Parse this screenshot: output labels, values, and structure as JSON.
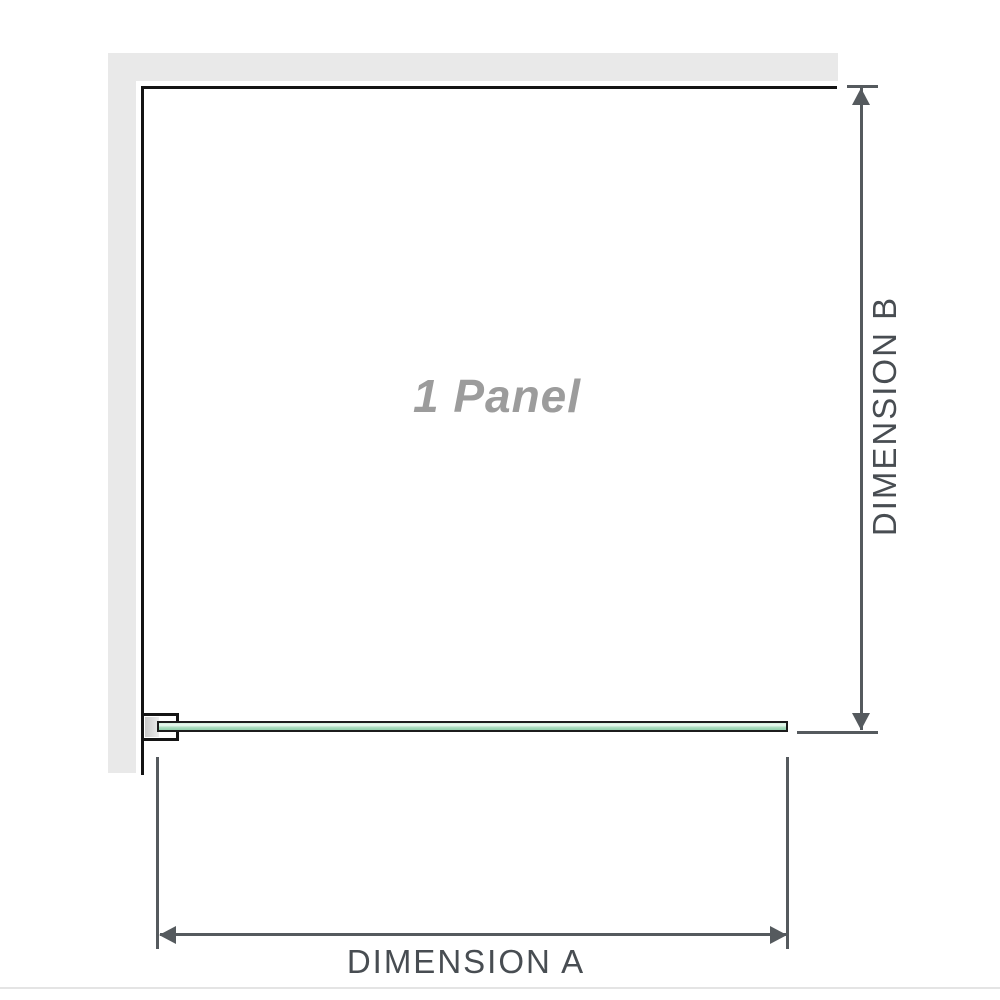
{
  "diagram": {
    "panel_label": "1 Panel",
    "dimension_a_label": "DIMENSION A",
    "dimension_b_label": "DIMENSION B"
  },
  "colors": {
    "wall_gray": "#e9e9e9",
    "outline_black": "#141414",
    "glass_green": "#a9dcbd",
    "glass_green_highlight": "#edfaf2",
    "glass_green_deep": "#8fcfab",
    "bracket_gray": "#c9c9c9",
    "dim_line_gray": "#555a5e",
    "dim_text_gray": "#484d52",
    "panel_label_gray": "#9c9c9c",
    "bottom_rule_gray": "#e4e4e4"
  }
}
